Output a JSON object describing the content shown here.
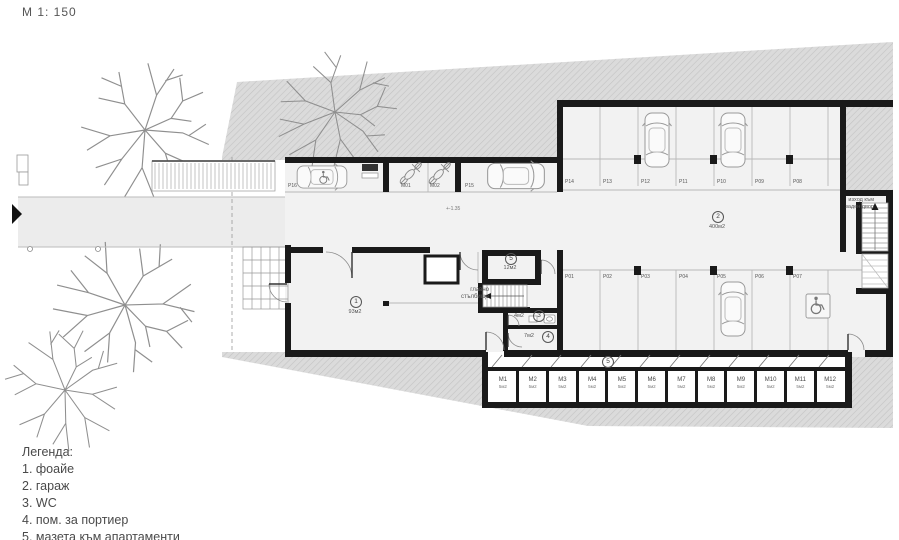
{
  "title": {
    "scale_label": "М 1: 150"
  },
  "plan": {
    "level_mark": "+-1.35",
    "main_stairs_label": "главно\nстълбище",
    "exit_label": "изход към\nзаден двор",
    "rooms": {
      "lobby": {
        "num": "1",
        "area": "93м2"
      },
      "garage": {
        "num": "2",
        "area": "400м2"
      },
      "wc": {
        "num": "3",
        "area": "4м2"
      },
      "porter": {
        "num": "4",
        "area": "7м2"
      },
      "cellar_room": {
        "num": "5",
        "area": "12м2"
      },
      "cellar_corridor": {
        "num": "5"
      }
    },
    "parking": {
      "top_row": [
        "P14",
        "P13",
        "P12",
        "P11",
        "P10",
        "P09",
        "P08"
      ],
      "middle_row": [
        "P01",
        "P02",
        "P03",
        "P04",
        "P05",
        "P06",
        "P07"
      ],
      "p16": "P16",
      "m01": "M01",
      "m02": "M02",
      "p15": "P15"
    },
    "cellars": [
      {
        "label": "M1",
        "area": "5м2"
      },
      {
        "label": "M2",
        "area": "5м2"
      },
      {
        "label": "M3",
        "area": "5м2"
      },
      {
        "label": "M4",
        "area": "5м2"
      },
      {
        "label": "M5",
        "area": "5м2"
      },
      {
        "label": "M6",
        "area": "5м2"
      },
      {
        "label": "M7",
        "area": "5м2"
      },
      {
        "label": "M8",
        "area": "5м2"
      },
      {
        "label": "M9",
        "area": "5м2"
      },
      {
        "label": "M10",
        "area": "5м2"
      },
      {
        "label": "M11",
        "area": "5м2"
      },
      {
        "label": "M12",
        "area": "5м2"
      }
    ]
  },
  "legend": {
    "title": "Легенда:",
    "items": [
      "1. фоайе",
      "2. гараж",
      "3. WC",
      "4. пом. за портиер",
      "5. мазета към апартаменти"
    ]
  },
  "colors": {
    "wall": "#1a1a1a",
    "hatch_bg": "#dbdbdb",
    "hatch_line": "#c3c3c3",
    "floor": "#f2f2f2",
    "thin_line": "#b8b8b8",
    "label_text": "#666666"
  }
}
